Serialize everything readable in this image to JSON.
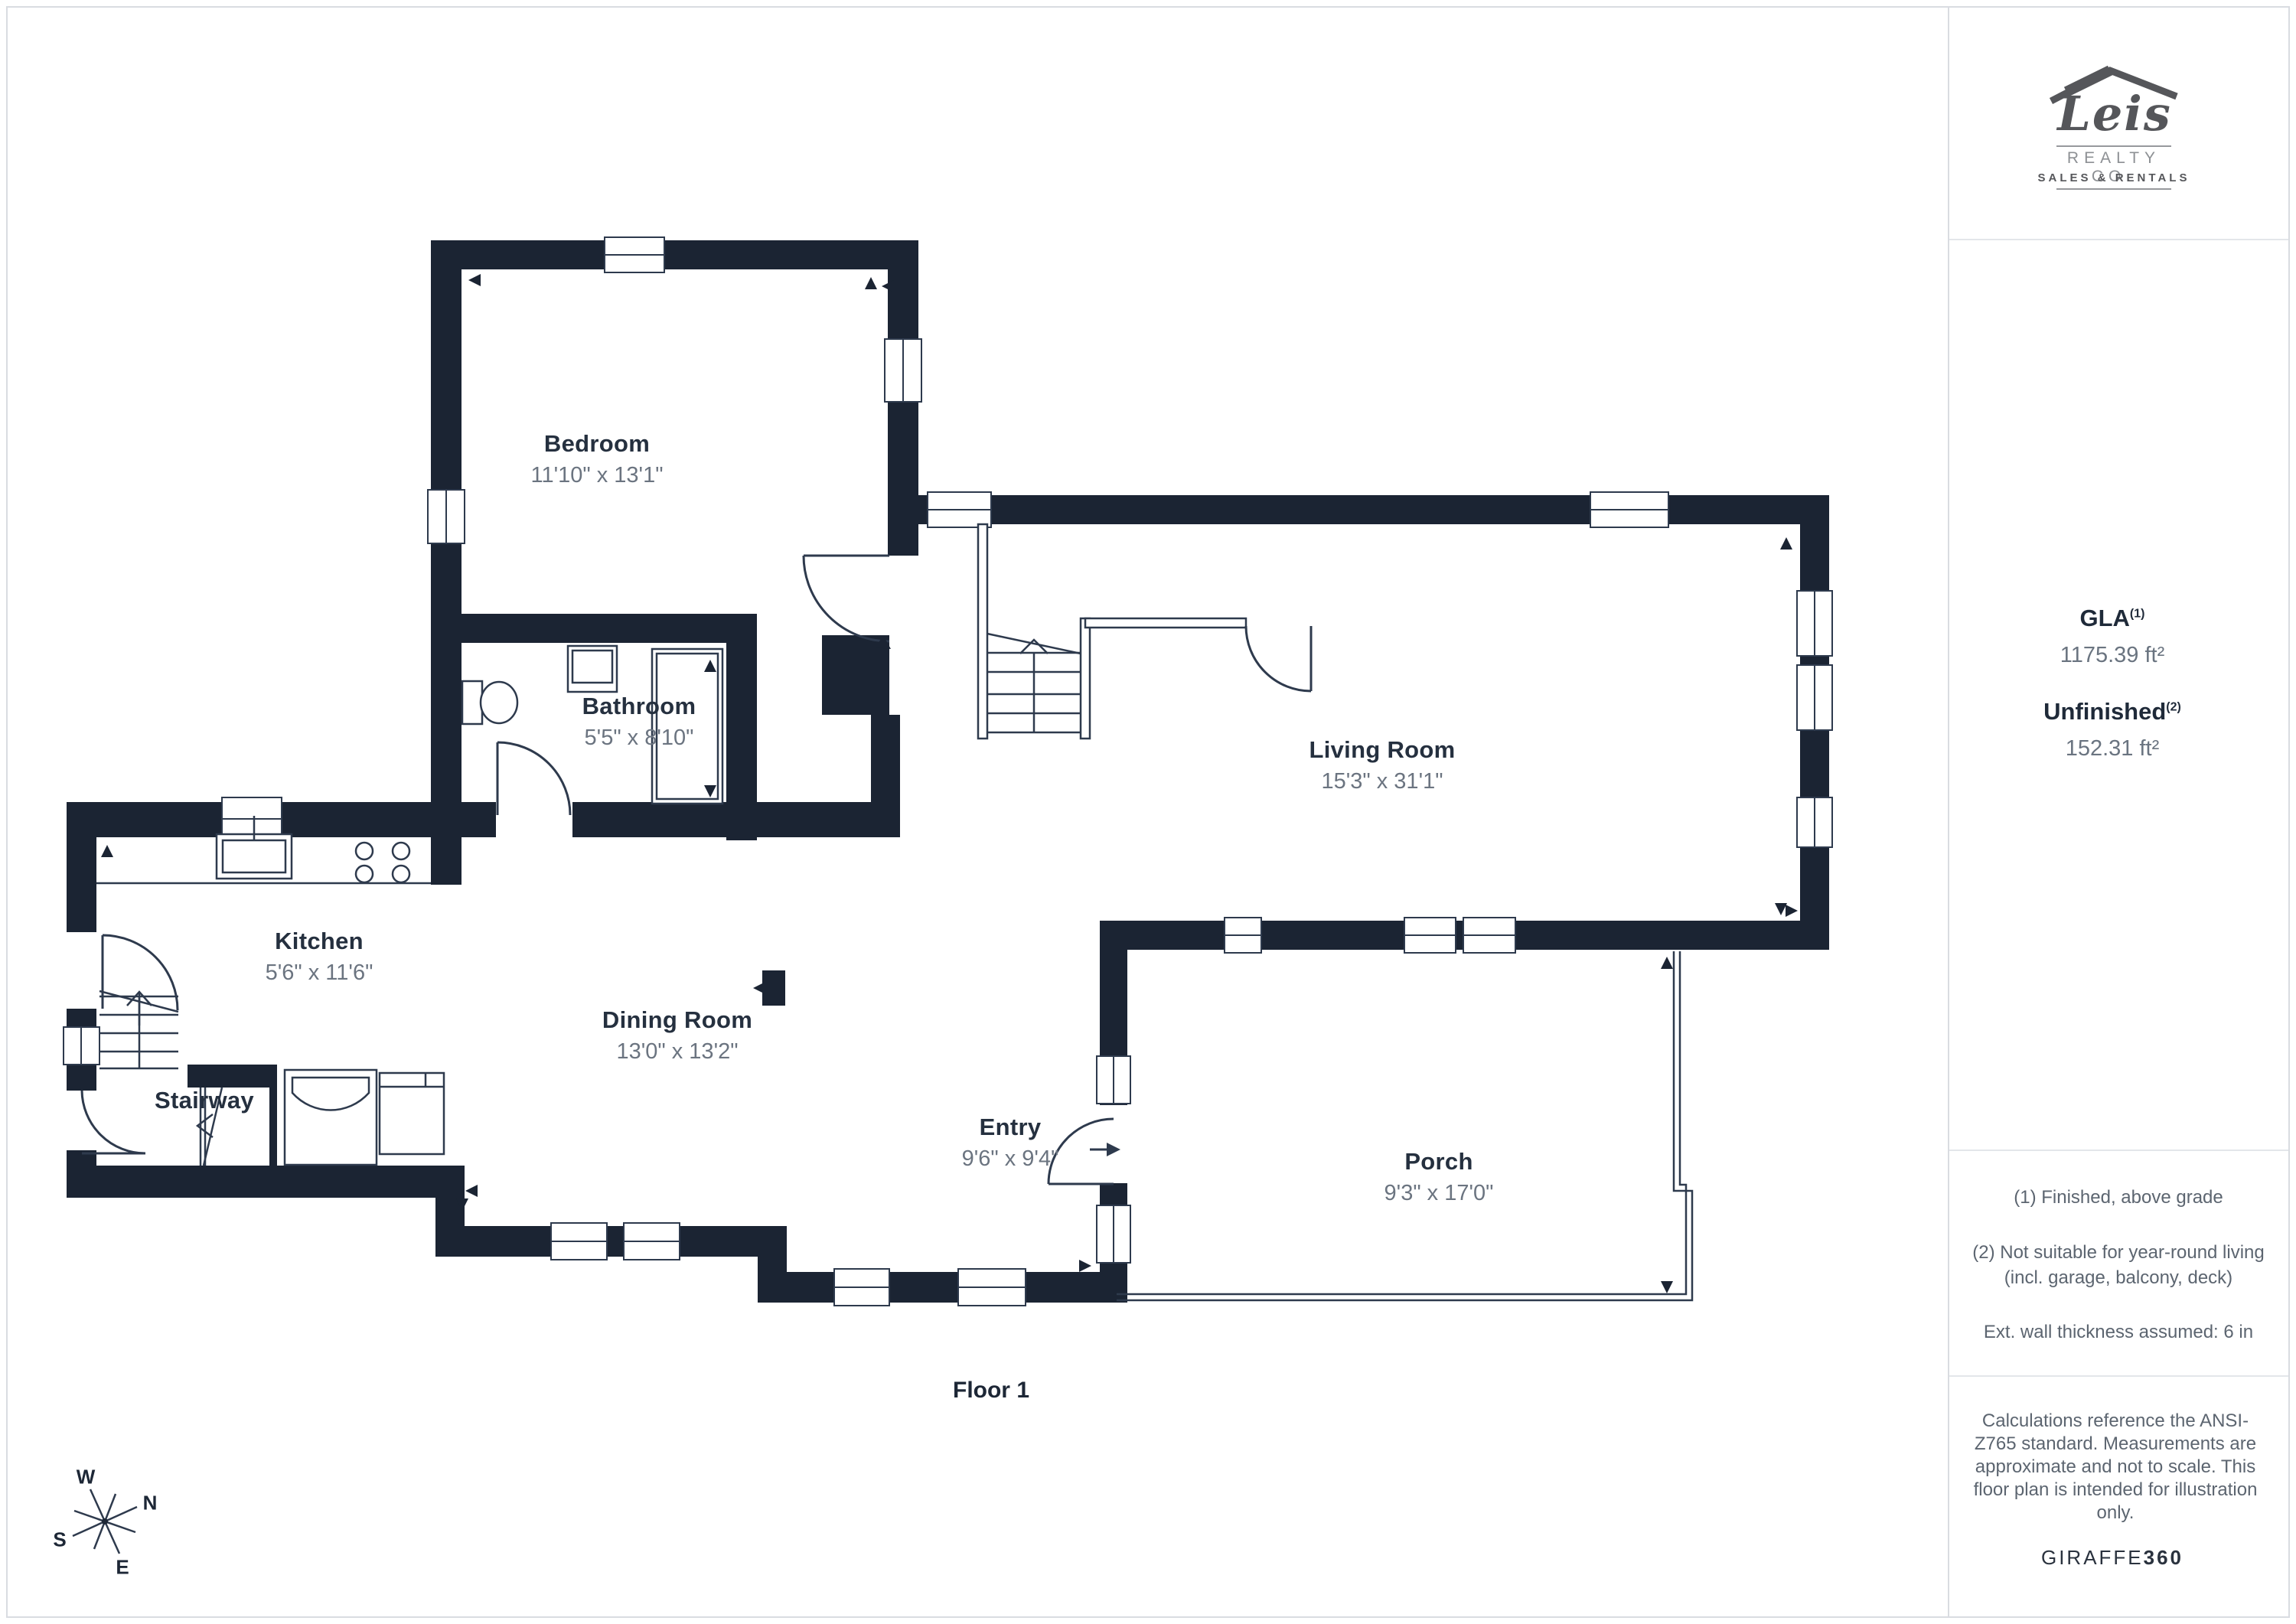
{
  "branding": {
    "logo_name": "Leis",
    "logo_sub": "REALTY CO.",
    "logo_tag": "SALES & RENTALS",
    "giraffe_normal": "GIRAFFE",
    "giraffe_bold": "360"
  },
  "metrics": {
    "gla_label": "GLA",
    "gla_sup": "(1)",
    "gla_value": "1175.39 ft²",
    "unfinished_label": "Unfinished",
    "unfinished_sup": "(2)",
    "unfinished_value": "152.31 ft²"
  },
  "footnotes": {
    "note1": "(1) Finished, above grade",
    "note2_line1": "(2) Not suitable for year-round living",
    "note2_line2": "(incl. garage, balcony, deck)",
    "note3": "Ext. wall thickness assumed: 6 in"
  },
  "disclaimer": "Calculations reference the ANSI-Z765 standard. Measurements are approximate and not to scale. This floor plan is intended for illustration only.",
  "floor_label": "Floor 1",
  "compass": {
    "n": "N",
    "s": "S",
    "e": "E",
    "w": "W"
  },
  "rooms": [
    {
      "name": "Bedroom",
      "dims": "11'10\" x 13'1\""
    },
    {
      "name": "Bathroom",
      "dims": "5'5\" x 8'10\""
    },
    {
      "name": "Living Room",
      "dims": "15'3\" x 31'1\""
    },
    {
      "name": "Kitchen",
      "dims": "5'6\" x 11'6\""
    },
    {
      "name": "Stairway",
      "dims": ""
    },
    {
      "name": "Dining Room",
      "dims": "13'0\" x 13'2\""
    },
    {
      "name": "Entry",
      "dims": "9'6\" x 9'4\""
    },
    {
      "name": "Porch",
      "dims": "9'3\" x 17'0\""
    }
  ]
}
